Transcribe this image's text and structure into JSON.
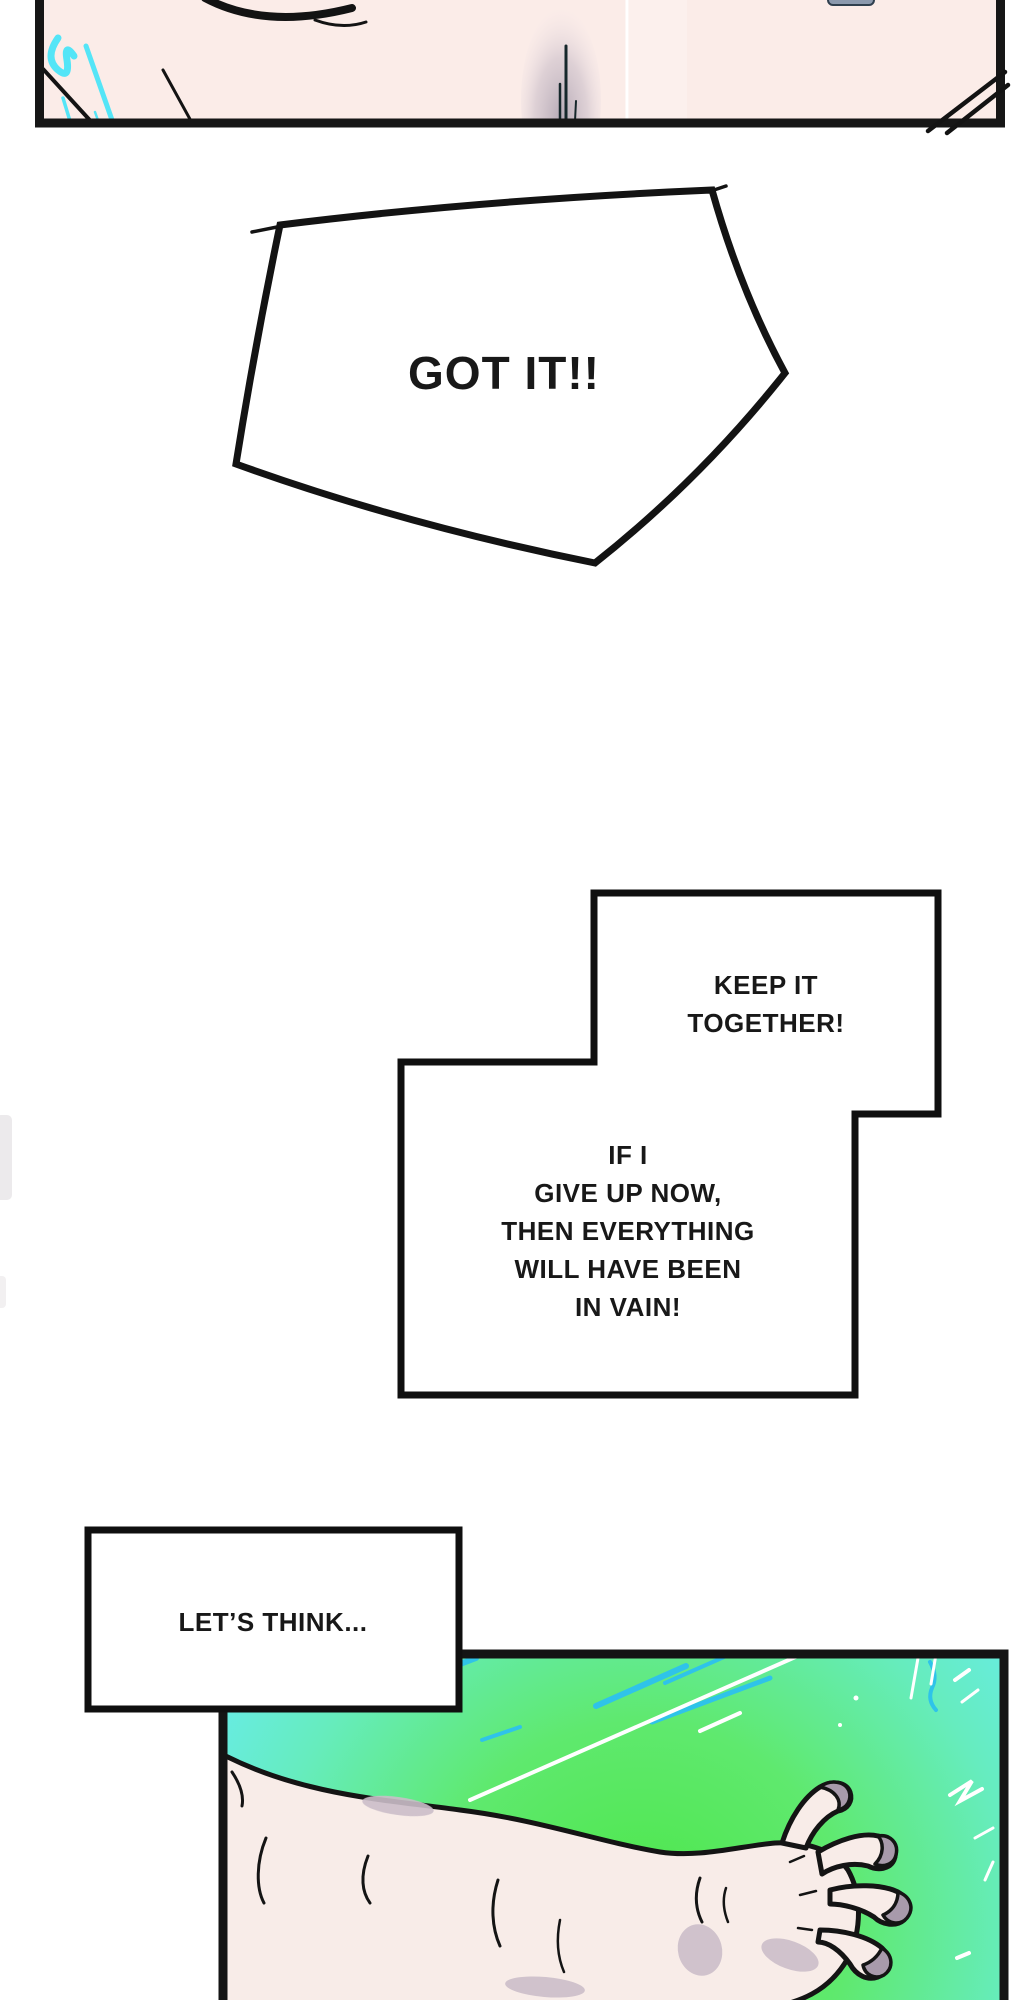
{
  "page": {
    "kind": "webtoon-comic-page",
    "background": "#ffffff"
  },
  "speech": {
    "got_it": {
      "text": "GOT IT!!"
    },
    "keep_it": {
      "lines": [
        "KEEP IT",
        "TOGETHER!"
      ]
    },
    "in_vain": {
      "lines": [
        "IF I",
        "GIVE UP NOW,",
        "THEN EVERYTHING",
        "WILL HAVE BEEN",
        "IN VAIN!"
      ]
    },
    "lets_think": {
      "text": "LET’S THINK..."
    }
  },
  "panels": {
    "top": {
      "description": "cropped close-up of pale skin with cyan highlight strokes and soft gray shadow",
      "skin_color": "#fbece8",
      "border_color": "#161616",
      "highlight_cyan": "#54e5f7",
      "shadow_gray": "#b2a6b3"
    },
    "bottom": {
      "description": "outstretched arm with clawed hand on cyan-green burst background",
      "border_color": "#141414",
      "cyan": "#68ebf4",
      "green": "#4be647",
      "skin": "#f8ece8",
      "skin_shadow": "#cbbec9",
      "nail_gray": "#a89aab",
      "speedline_blue": "#2fc3e9",
      "speedline_white": "#ffffff"
    }
  }
}
